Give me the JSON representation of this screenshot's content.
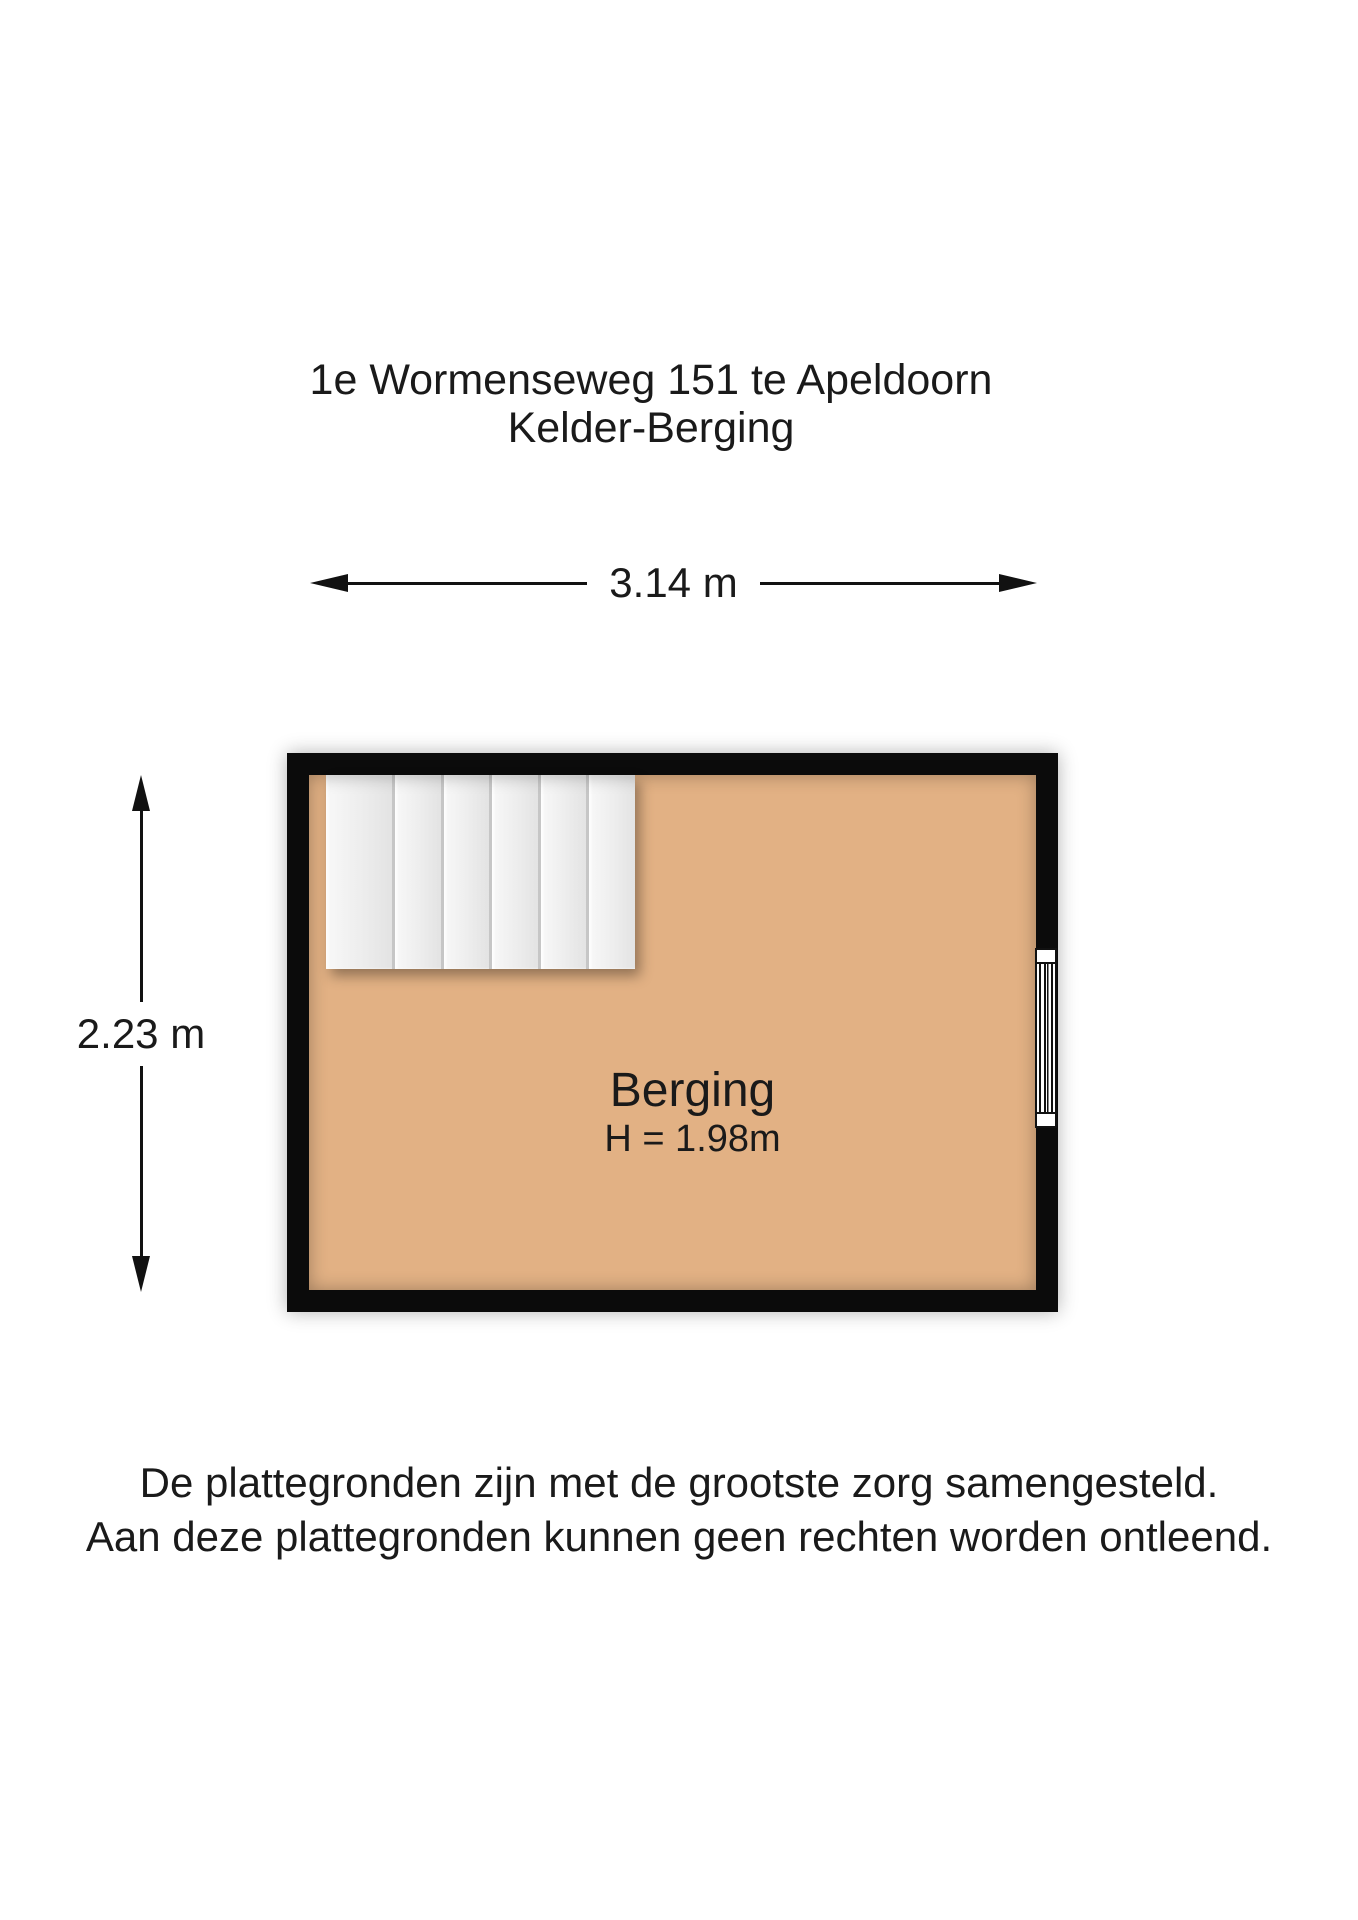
{
  "title": {
    "line1": "1e Wormenseweg 151 te Apeldoorn",
    "line2": "Kelder-Berging"
  },
  "dimensions": {
    "width": "3.14 m",
    "height": "2.23 m"
  },
  "room": {
    "name": "Berging",
    "ceiling_height": "H = 1.98m"
  },
  "floorplan": {
    "stair_tread_count": 6,
    "window_count": 1
  },
  "colors": {
    "floor": "#e2b184",
    "wall": "#0b0b0b",
    "stair": "#ededed",
    "line": "#111111",
    "background": "#ffffff"
  },
  "footer": {
    "line1": "De plattegronden zijn met de grootste zorg samengesteld.",
    "line2": "Aan deze plattegronden kunnen geen rechten worden ontleend."
  }
}
